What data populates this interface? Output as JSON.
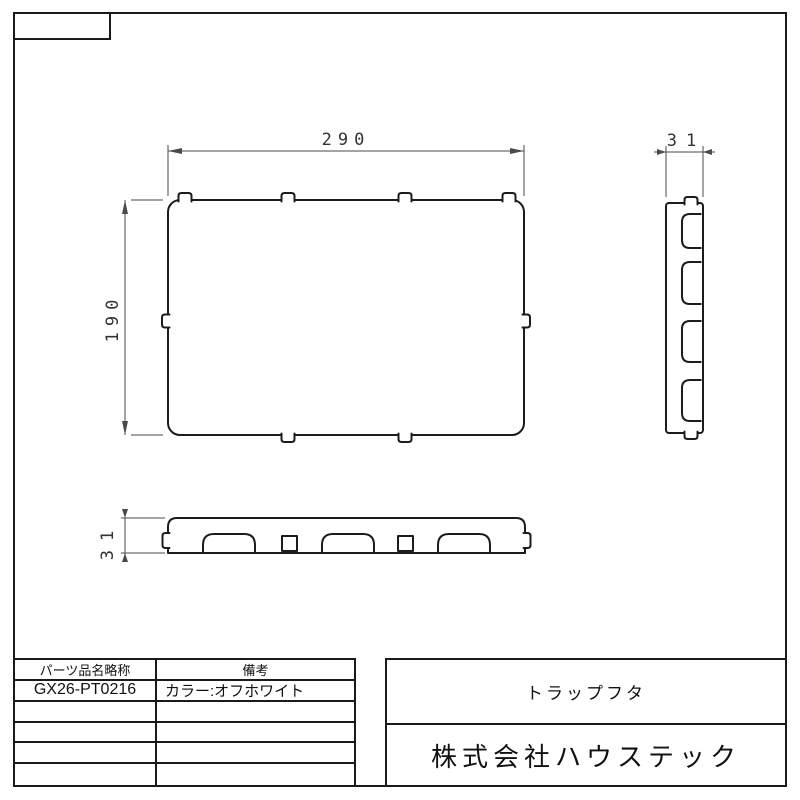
{
  "page": {
    "background": "#ffffff",
    "outline_color": "#1c1c1c",
    "dimension_color": "#4a4a4a"
  },
  "drawing": {
    "plan_view": {
      "width_dim": "290",
      "height_dim": "190"
    },
    "side_view": {
      "thickness_dim": "31"
    },
    "bottom_view": {
      "thickness_dim": "31"
    }
  },
  "parts_table": {
    "headers": [
      "パーツ品名略称",
      "備考"
    ],
    "rows": [
      {
        "part_no": "GX26-PT0216",
        "remark": "カラー:オフホワイト"
      }
    ],
    "empty_row_count": 4
  },
  "title_block": {
    "part_name": "トラップフタ",
    "company": "株式会社ハウステック"
  }
}
